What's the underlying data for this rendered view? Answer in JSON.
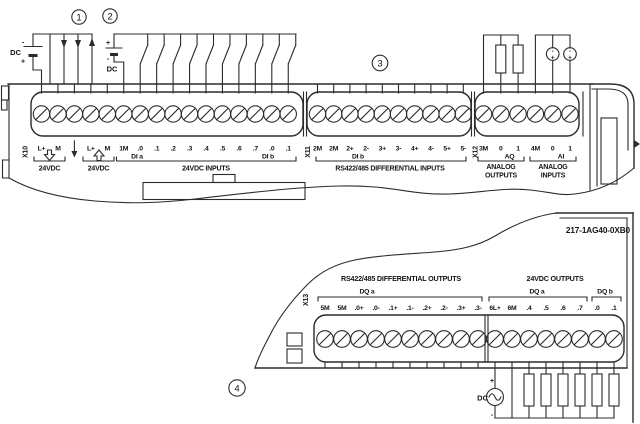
{
  "callouts": {
    "one": "1",
    "two": "2",
    "three": "3",
    "four": "4"
  },
  "part_number": "217-1AG40-0XB0",
  "upper": {
    "x10": {
      "connector": "X10",
      "terminals": [
        "L+",
        "M",
        "",
        "L+",
        "M",
        "1M",
        ".0",
        ".1",
        ".2",
        ".3",
        ".4",
        ".5",
        ".6",
        ".7",
        ".0",
        ".1"
      ],
      "group1_caption": "24VDC",
      "group2_caption": "24VDC",
      "group3_caption": "24VDC INPUTS",
      "di_a": "DI a",
      "di_b": "DI b"
    },
    "x11": {
      "connector": "X11",
      "terminals": [
        "2M",
        "2M",
        "2+",
        "2-",
        "3+",
        "3-",
        "4+",
        "4-",
        "5+",
        "5-"
      ],
      "di_b": "DI b",
      "caption": "RS422/485 DIFFERENTIAL INPUTS"
    },
    "x12": {
      "connector": "X12",
      "terminals": [
        "3M",
        "0",
        "1",
        "4M",
        "0",
        "1"
      ],
      "aq": "AQ",
      "ai": "AI",
      "caption_outputs_line1": "ANALOG",
      "caption_outputs_line2": "OUTPUTS",
      "caption_inputs_line1": "ANALOG",
      "caption_inputs_line2": "INPUTS"
    },
    "left_supply": {
      "label": "DC",
      "minus": "-",
      "plus": "+"
    },
    "input_supply": {
      "label": "DC",
      "plus": "+",
      "minus": "-"
    },
    "analog_sources": {
      "minus": "-",
      "plus": "+"
    }
  },
  "lower": {
    "x13": {
      "connector": "X13",
      "header_left": "RS422/485 DIFFERENTIAL OUTPUTS",
      "header_right": "24VDC OUTPUTS",
      "dq_a_left": "DQ a",
      "dq_a_right": "DQ a",
      "dq_b": "DQ b",
      "terminals": [
        "5M",
        "5M",
        ".0+",
        ".0-",
        ".1+",
        ".1-",
        ".2+",
        ".2-",
        ".3+",
        ".3-",
        "6L+",
        "6M",
        ".4",
        ".5",
        ".6",
        ".7",
        ".0",
        ".1"
      ]
    },
    "output_supply": {
      "label": "DC",
      "plus": "+",
      "minus": "-"
    }
  }
}
